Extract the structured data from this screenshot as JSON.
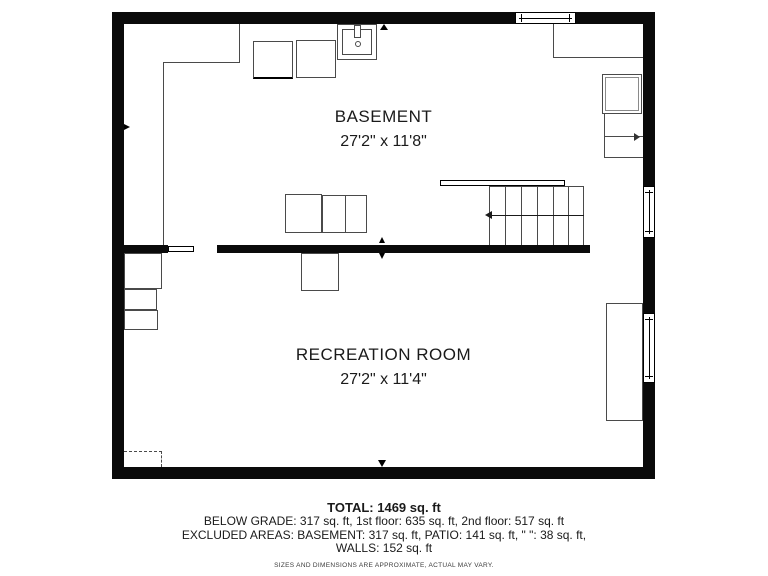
{
  "floor_plan": {
    "rooms": [
      {
        "name": "BASEMENT",
        "dimensions": "27'2\" x 11'8\""
      },
      {
        "name": "RECREATION ROOM",
        "dimensions": "27'2\" x 11'4\""
      }
    ],
    "fixtures": [
      "laundry-sink",
      "washer",
      "dryer",
      "stairs-with-direction-arrow",
      "door",
      "windows",
      "crawl-space-dashed"
    ],
    "colors": {
      "wall": "#0a0a0a",
      "furniture_line": "#4a4a4a",
      "background": "#ffffff"
    }
  },
  "summary": {
    "total": "TOTAL: 1469 sq. ft",
    "lines": [
      "BELOW GRADE: 317 sq. ft, 1st floor: 635 sq. ft, 2nd floor: 517 sq. ft",
      "EXCLUDED AREAS: BASEMENT: 317 sq. ft, PATIO: 141 sq. ft, \" \": 38 sq. ft,",
      "WALLS: 152 sq. ft"
    ],
    "disclaimer": "SIZES AND DIMENSIONS ARE APPROXIMATE, ACTUAL MAY VARY."
  }
}
